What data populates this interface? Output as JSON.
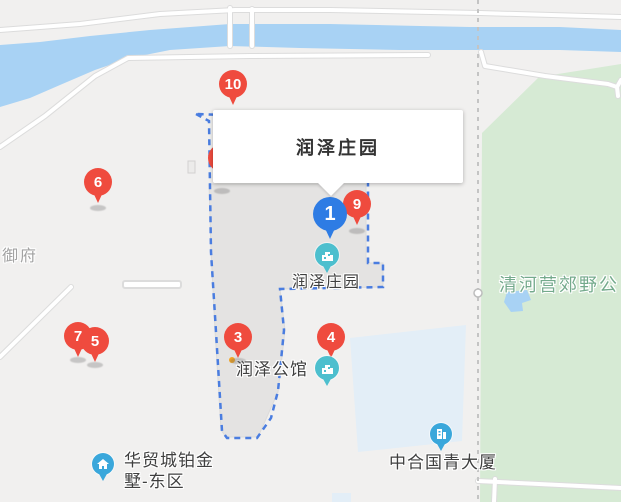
{
  "callout": {
    "title": "润泽庄园"
  },
  "pins": {
    "p1": {
      "label": "1"
    },
    "p3": {
      "label": "3"
    },
    "p4": {
      "label": "4"
    },
    "p5": {
      "label": "5"
    },
    "p6": {
      "label": "6"
    },
    "p7": {
      "label": "7"
    },
    "p9": {
      "label": "9"
    },
    "p10": {
      "label": "10"
    }
  },
  "poi_labels": {
    "runze_manor": "润泽庄园",
    "runze_mansion": "润泽公馆",
    "huamao_line1": "华贸城铂金",
    "huamao_line2": "墅-东区",
    "zhonghe": "中合国青大厦"
  },
  "area_labels": {
    "yufu": "御府",
    "qinghe_park": "清河营郊野公"
  },
  "icons": {
    "red_pin": "red-map-pin",
    "blue_pin": "selected-blue-map-pin",
    "teal_poi": "teal-building-poi-icon",
    "blue_poi": "blue-building-poi-icon"
  },
  "colors": {
    "map_background": "#f1f0ef",
    "river": "#a8d2f4",
    "park": "#d6ead4",
    "park_text": "#74aa8c",
    "building_block": "#e4e3e2",
    "building_block_blue": "#e3eef7",
    "boundary_dash": "#4a7de0",
    "admin_dash": "#c4c4c4",
    "pin_red": "#ef4b3e",
    "pin_blue": "#2e7ce4",
    "poi_teal": "#4dbfce",
    "poi_blue": "#3aa7db",
    "label_text": "#3f3f3f",
    "area_text": "#a2a2a2"
  }
}
